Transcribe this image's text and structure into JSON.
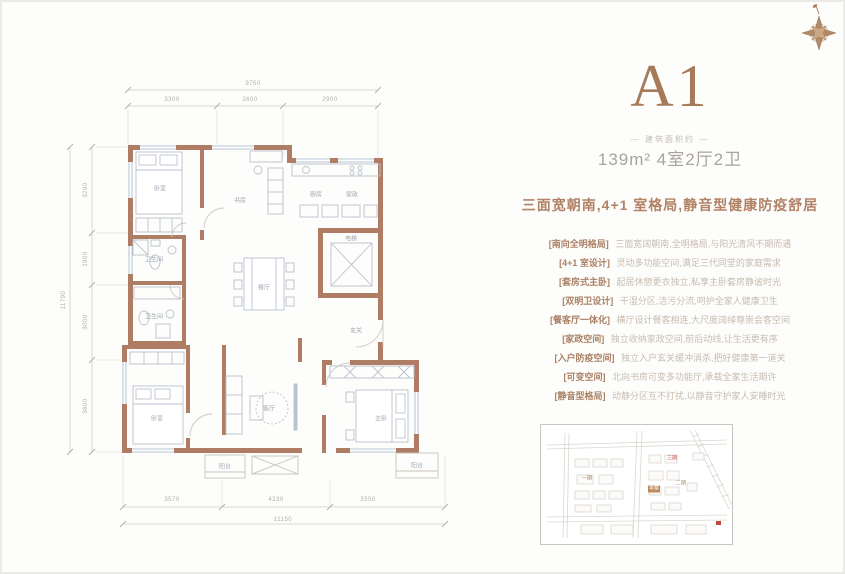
{
  "colors": {
    "accent_brown": "#a57b59",
    "wall_brown": "#ae7d64",
    "tagline_brown": "#b28266",
    "map_red": "#bf5a4a"
  },
  "unit": {
    "title": "A1",
    "area_label": "— 建筑面积约 —",
    "spec": "139m² 4室2厅2卫",
    "tagline": "三面宽朝南,4+1 室格局,静音型健康防疫舒居"
  },
  "features": [
    {
      "label": "[南向全明格局]",
      "desc": "三面宽阔朝南,全明格局,与阳光清风不期而遇"
    },
    {
      "label": "[4+1 室设计]",
      "desc": "灵动多功能空间,满足三代同堂的家庭需求"
    },
    {
      "label": "[套房式主卧]",
      "desc": "起居休憩更衣独立,私享主卧套房静谧时光"
    },
    {
      "label": "[双明卫设计]",
      "desc": "干湿分区,洁污分流,呵护全家人健康卫生"
    },
    {
      "label": "[餐客厅一体化]",
      "desc": "横厅设计餐客相连,大尺度阔绰尊崇会客空间"
    },
    {
      "label": "[家政空间]",
      "desc": "独立收纳家政空间,前后动线,让生活更有序"
    },
    {
      "label": "[入户防疫空间]",
      "desc": "独立入户玄关缓冲消杀,把好健康第一道关"
    },
    {
      "label": "[可变空间]",
      "desc": "北向书房可变多功能厅,承载全家生活期许"
    },
    {
      "label": "[静音型格局]",
      "desc": "动静分区互不打扰,以静音守护家人安睡时光"
    }
  ],
  "plan": {
    "room_labels": [
      {
        "x": 160,
        "y": 188,
        "text": "卧室"
      },
      {
        "x": 240,
        "y": 200,
        "text": "书房"
      },
      {
        "x": 316,
        "y": 194,
        "text": "厨房"
      },
      {
        "x": 352,
        "y": 194,
        "text": "家政"
      },
      {
        "x": 351,
        "y": 238,
        "text": "电梯"
      },
      {
        "x": 154,
        "y": 259,
        "text": "卫生间"
      },
      {
        "x": 154,
        "y": 316,
        "text": "卫生间"
      },
      {
        "x": 264,
        "y": 287,
        "text": "餐厅"
      },
      {
        "x": 356,
        "y": 330,
        "text": "玄关"
      },
      {
        "x": 269,
        "y": 408,
        "text": "客厅"
      },
      {
        "x": 157,
        "y": 418,
        "text": "卧室"
      },
      {
        "x": 381,
        "y": 418,
        "text": "主卧"
      },
      {
        "x": 225,
        "y": 466,
        "text": "阳台"
      },
      {
        "x": 417,
        "y": 465,
        "text": "阳台"
      }
    ],
    "dim_labels": [
      {
        "x": 253,
        "y": 84,
        "text": "9750"
      },
      {
        "x": 172,
        "y": 100,
        "text": "3300"
      },
      {
        "x": 250,
        "y": 100,
        "text": "2600"
      },
      {
        "x": 330,
        "y": 100,
        "text": "2900"
      },
      {
        "x": 64,
        "y": 300,
        "text": "11790",
        "rot": -90
      },
      {
        "x": 86,
        "y": 190,
        "text": "3290",
        "rot": -90
      },
      {
        "x": 86,
        "y": 259,
        "text": "1900",
        "rot": -90
      },
      {
        "x": 86,
        "y": 322,
        "text": "3000",
        "rot": -90
      },
      {
        "x": 86,
        "y": 406,
        "text": "3600",
        "rot": -90
      },
      {
        "x": 172,
        "y": 500,
        "text": "3570"
      },
      {
        "x": 276,
        "y": 500,
        "text": "4230"
      },
      {
        "x": 368,
        "y": 500,
        "text": "3350"
      },
      {
        "x": 283,
        "y": 520,
        "text": "11150"
      }
    ]
  },
  "map": {
    "labels": [
      {
        "x": 46,
        "y": 54,
        "text": "一期",
        "color": "#a98868"
      },
      {
        "x": 131,
        "y": 34,
        "text": "三期",
        "color": "#bf5a4a"
      },
      {
        "x": 140,
        "y": 59,
        "text": "二期",
        "color": "#a98868"
      },
      {
        "x": 113,
        "y": 64,
        "text": "本案",
        "color": "#ffffff",
        "bg": "#bc8a5e"
      }
    ]
  }
}
